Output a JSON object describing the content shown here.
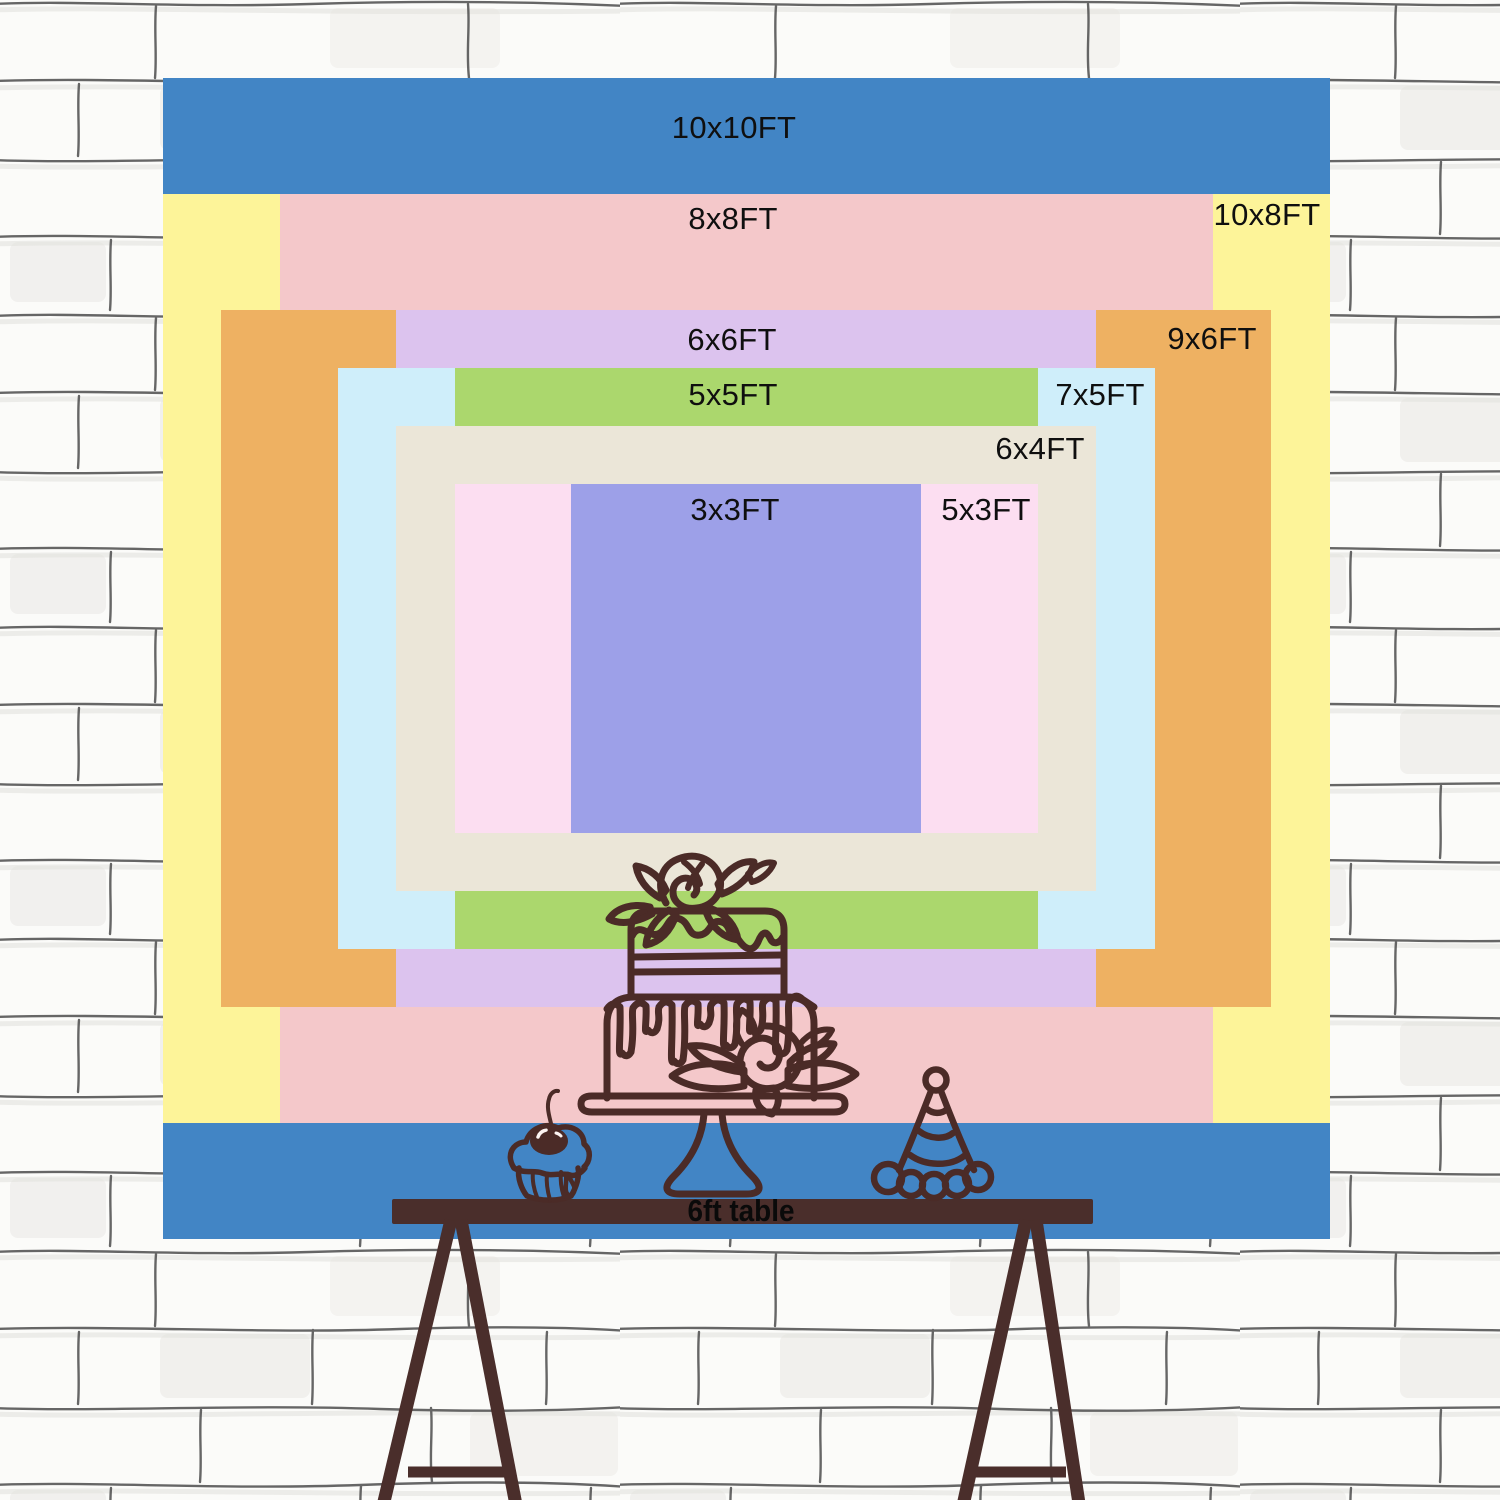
{
  "backdrop_sizes": [
    {
      "label": "10x10FT",
      "color": "#4285c5"
    },
    {
      "label": "8x8FT",
      "color": "#f4c8ca"
    },
    {
      "label": "10x8FT",
      "color": "#fdf499"
    },
    {
      "label": "6x6FT",
      "color": "#dcc3ee"
    },
    {
      "label": "9x6FT",
      "color": "#eeb162"
    },
    {
      "label": "5x5FT",
      "color": "#abd76d"
    },
    {
      "label": "7x5FT",
      "color": "#cfeefa"
    },
    {
      "label": "6x4FT",
      "color": "#ebe6d8"
    },
    {
      "label": "3x3FT",
      "color": "#9da0e8"
    },
    {
      "label": "5x3FT",
      "color": "#fcdef1"
    }
  ],
  "table": {
    "label": "6ft table",
    "color": "#4a2e2b"
  },
  "artwork": {
    "line_color": "#4b2b27",
    "items": [
      "cake-icon",
      "cupcake-icon",
      "party-hat-icon"
    ]
  },
  "wall": {
    "background": "#fbfbf9",
    "brick_line_color": "#4c4c4c"
  },
  "label_text_color": "#0f0f0f"
}
